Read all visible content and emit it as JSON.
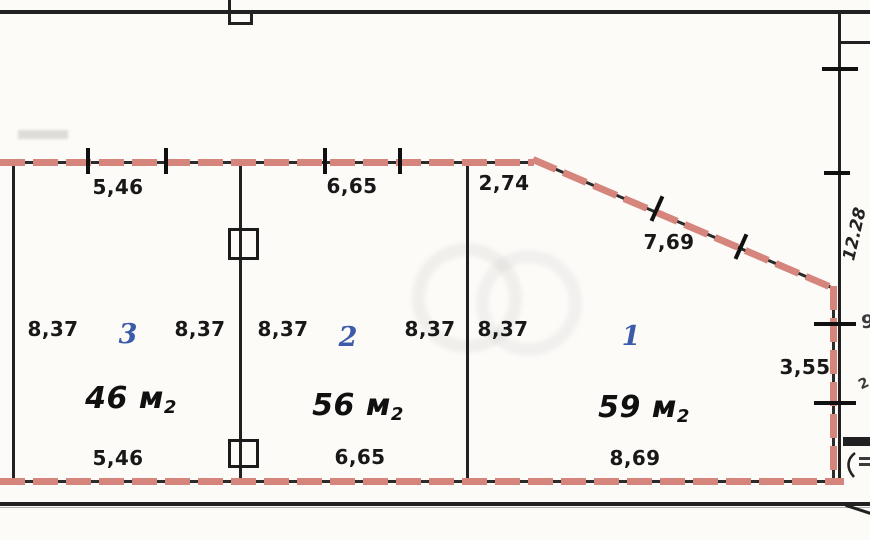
{
  "plan": {
    "colors": {
      "wall_red": "#d6857c",
      "line_black": "#212121",
      "room_number_blue": "#3c5ba8"
    },
    "top_dimensions": {
      "left": "5,46",
      "middle": "6,65",
      "corner": "2,74",
      "diagonal": "7,69"
    },
    "width_dimensions": [
      "8,37",
      "8,37",
      "8,37",
      "8,37",
      "8,37"
    ],
    "rooms": [
      {
        "number": "3",
        "area_value": "46",
        "area_unit": "м",
        "area_sub": "2",
        "bottom_dim": "5,46"
      },
      {
        "number": "2",
        "area_value": "56",
        "area_unit": "м",
        "area_sub": "2",
        "bottom_dim": "6,65"
      },
      {
        "number": "1",
        "area_value": "59",
        "area_unit": "м",
        "area_sub": "2",
        "bottom_dim": "8,69"
      }
    ],
    "right_dimensions": {
      "height": "12.28",
      "segment": "3,55"
    },
    "edge_fragments": {
      "upper": "9",
      "lower": "2"
    }
  }
}
